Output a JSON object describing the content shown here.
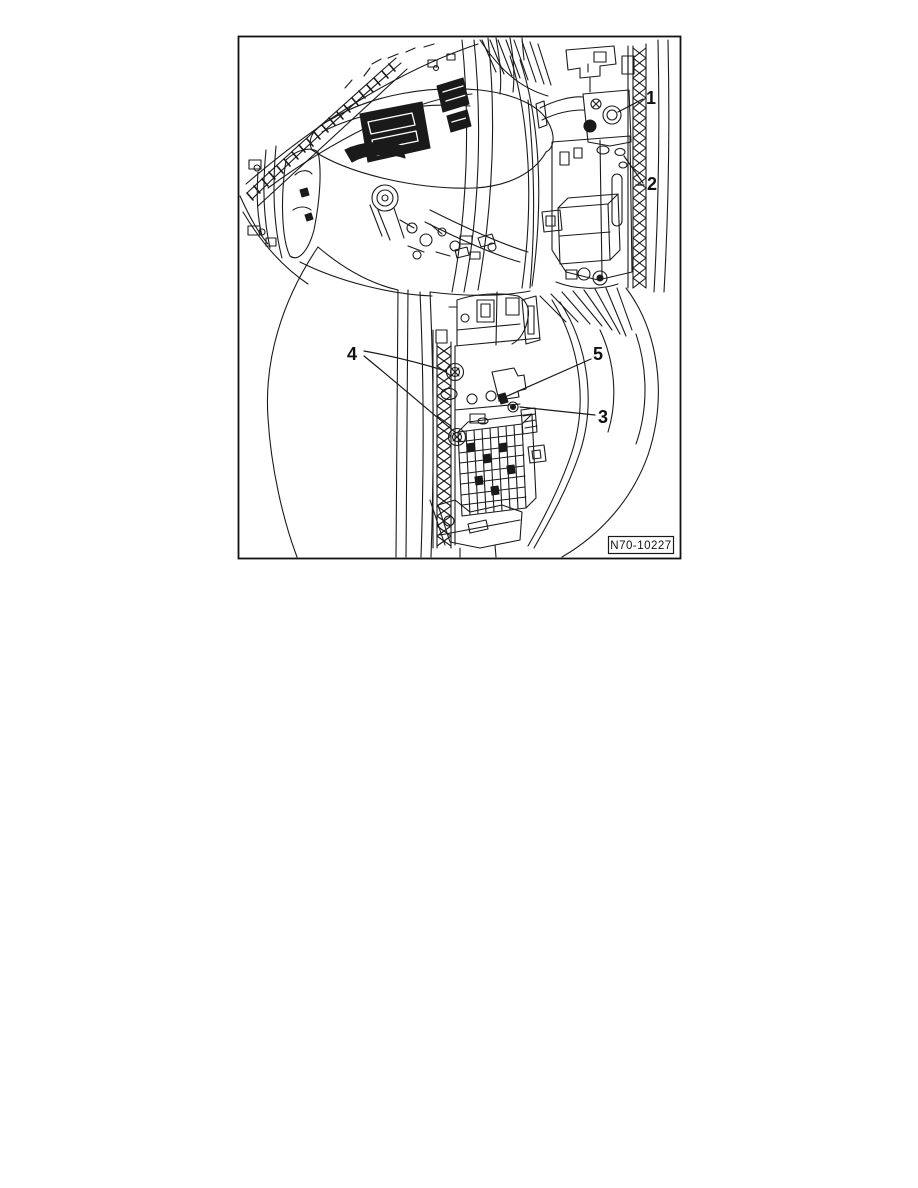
{
  "page": {
    "background": "#ffffff",
    "ink": "#1a1a1a"
  },
  "figure": {
    "code": "N70-10227",
    "callouts": [
      {
        "label": "1"
      },
      {
        "label": "2"
      },
      {
        "label": "3"
      },
      {
        "label": "4"
      },
      {
        "label": "5"
      }
    ]
  }
}
